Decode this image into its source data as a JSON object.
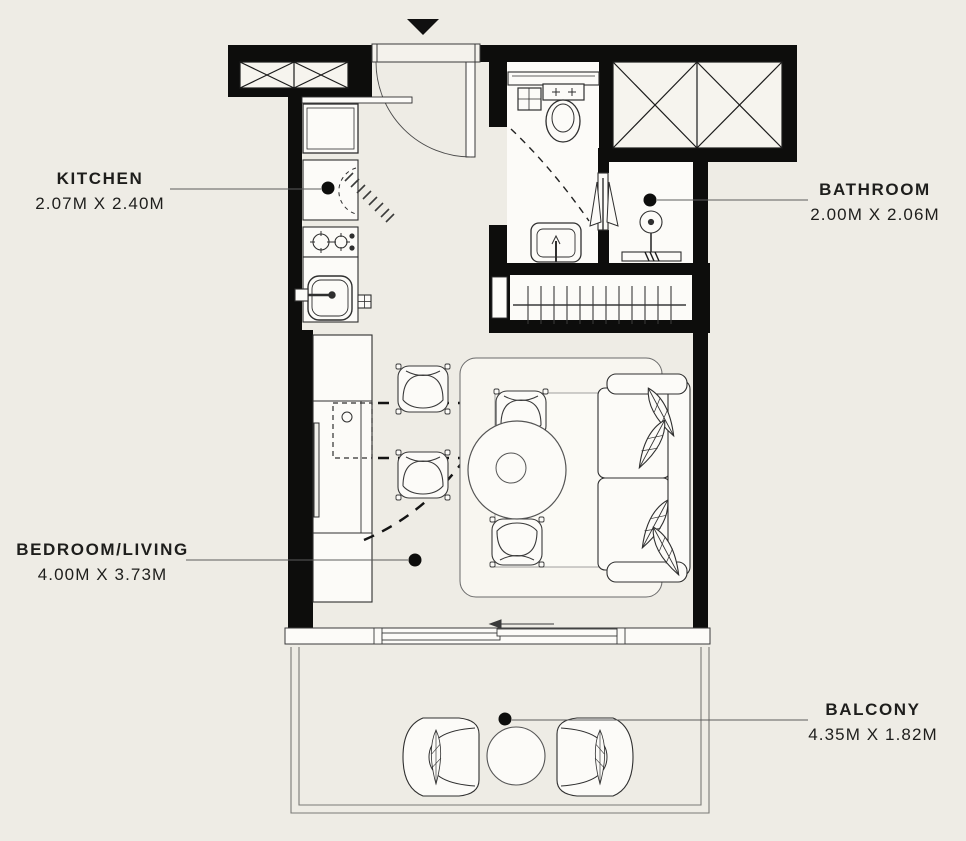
{
  "page": {
    "background": "#eeece5"
  },
  "colors": {
    "wall": "#0d0d0c",
    "furniture_line": "#2f2f2f",
    "thin_line": "#777777",
    "floor_white": "#fcfbf8",
    "label_text": "#1e1e1c"
  },
  "entrance": {
    "marker": "entrance-arrow"
  },
  "rooms": {
    "kitchen": {
      "label": "KITCHEN",
      "dimensions": "2.07M X 2.40M"
    },
    "bathroom": {
      "label": "BATHROOM",
      "dimensions": "2.00M X 2.06M"
    },
    "bedroom_living": {
      "label": "BEDROOM/LIVING",
      "dimensions": "4.00M X 3.73M"
    },
    "balcony": {
      "label": "BALCONY",
      "dimensions": "4.35M X 1.82M"
    }
  }
}
